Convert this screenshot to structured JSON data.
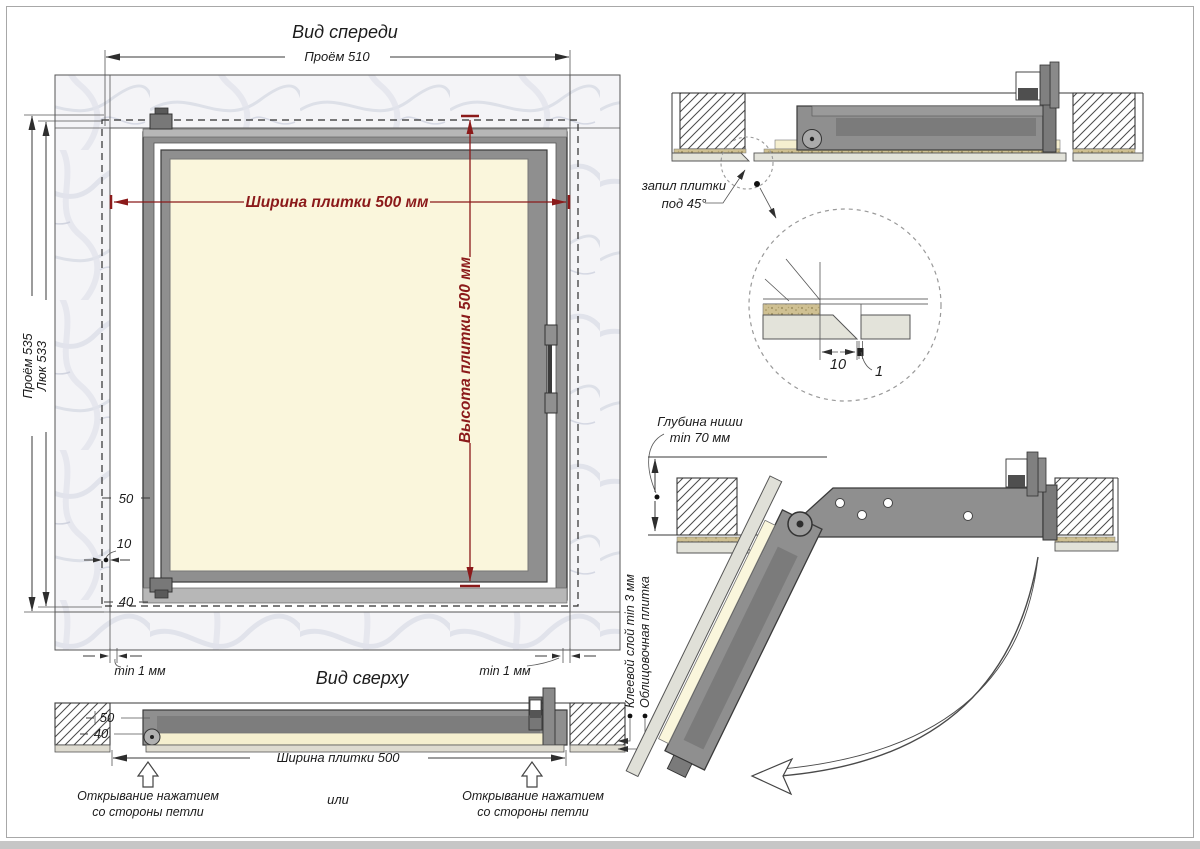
{
  "fv": {
    "title": "Вид спереди",
    "proem510": "Проём 510",
    "proem535": "Проём 535",
    "luk533": "Люк 533",
    "tile_w": "Ширина плитки 500 мм",
    "tile_h": "Высота плитки 500 мм",
    "d50": "50",
    "d10": "10",
    "d40": "40",
    "gapL": "min 1 мм",
    "gapR": "min 1 мм"
  },
  "tv": {
    "title": "Вид сверху",
    "d50": "50",
    "d40": "40",
    "tile_w": "Ширина плитки 500",
    "openL1": "Открывание нажатием",
    "openL2": "со стороны петли",
    "or": "или",
    "openR1": "Открывание нажатием",
    "openR2": "со стороны петли"
  },
  "co": {
    "adhesive": "Клеевой слой min 3 мм",
    "tile": "Облицовочная плитка",
    "cut1": "запил плитки",
    "cut2": "под 45°",
    "niche1": "Глубина ниши",
    "niche2": "min 70 мм",
    "d10": "10",
    "d1": "1"
  },
  "colors": {
    "dimension_red": "#8B1A1A",
    "frame_gray": "#8f8f8f",
    "tile_cream": "#FAF6DC",
    "marble": "#f4f4f7",
    "line": "#3a3a3a"
  }
}
